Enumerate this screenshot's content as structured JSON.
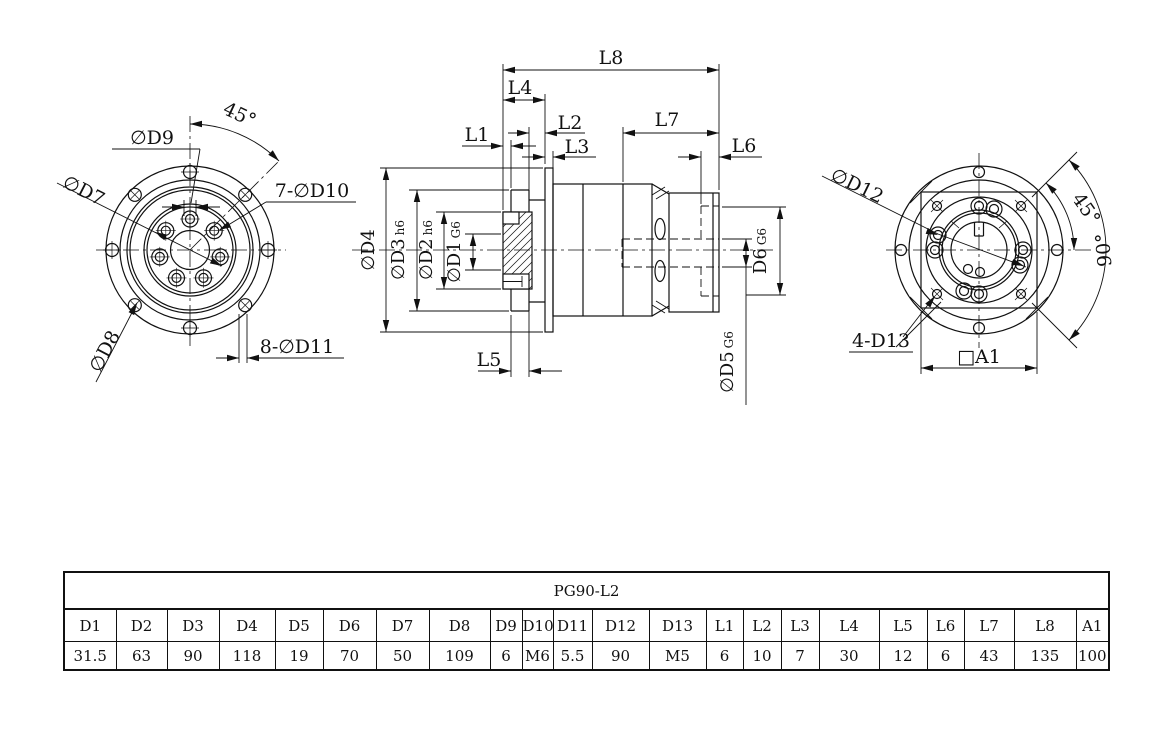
{
  "drawing": {
    "front_view": {
      "d9_label": "∅D9",
      "angle_label": "45°",
      "d7_label": "∅D7",
      "d10_label": "7-∅D10",
      "d8_label": "∅D8",
      "d11_label": "8-∅D11"
    },
    "side_view": {
      "l8": "L8",
      "l4": "L4",
      "l1": "L1",
      "l2": "L2",
      "l3": "L3",
      "l7": "L7",
      "l6": "L6",
      "l5": "L5",
      "d4": "∅D4",
      "d3": "∅D3",
      "d3_tol": "h6",
      "d2": "∅D2",
      "d2_tol": "h6",
      "d1": "∅D1",
      "d1_tol": "G6",
      "d6": "D6",
      "d6_tol": "G6",
      "d5": "∅D5",
      "d5_tol": "G6"
    },
    "rear_view": {
      "d12_label": "∅D12",
      "angle45_label": "45°",
      "angle90_label": "90°",
      "d13_label": "4-D13",
      "a1_label": "□A1"
    },
    "colors": {
      "line": "#111111",
      "background": "#ffffff"
    }
  },
  "table": {
    "title": "PG90-L2",
    "columns": [
      "D1",
      "D2",
      "D3",
      "D4",
      "D5",
      "D6",
      "D7",
      "D8",
      "D9",
      "D10",
      "D11",
      "D12",
      "D13",
      "L1",
      "L2",
      "L3",
      "L4",
      "L5",
      "L6",
      "L7",
      "L8",
      "A1"
    ],
    "values": [
      "31.5",
      "63",
      "90",
      "118",
      "19",
      "70",
      "50",
      "109",
      "6",
      "M6",
      "5.5",
      "90",
      "M5",
      "6",
      "10",
      "7",
      "30",
      "12",
      "6",
      "43",
      "135",
      "100"
    ]
  }
}
